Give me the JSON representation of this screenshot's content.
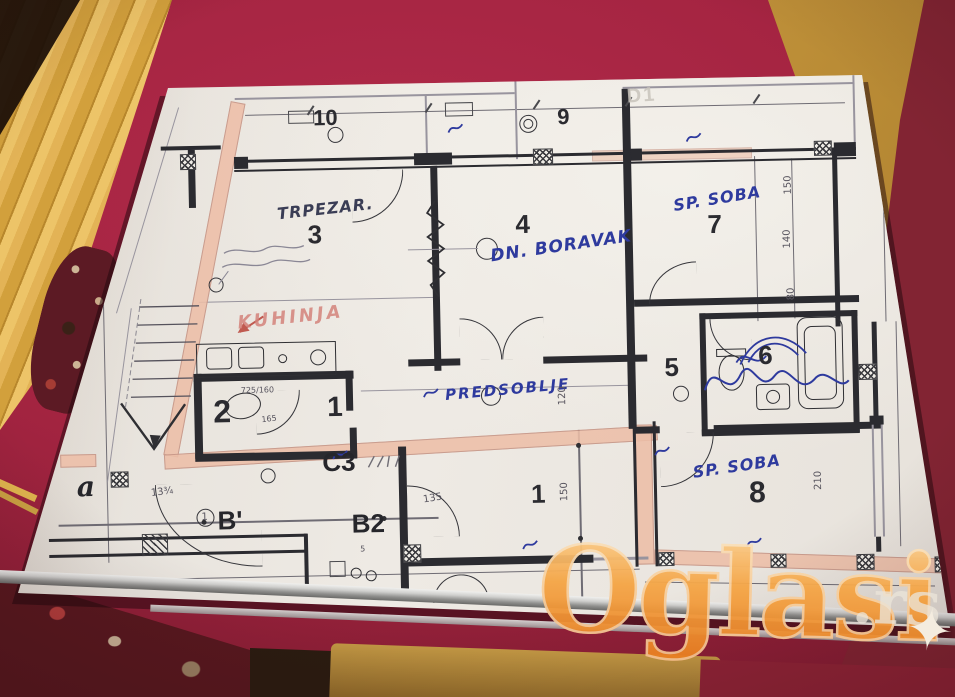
{
  "photo": {
    "watermark": {
      "text": "Oglasi",
      "suffix": ".rs",
      "sparkle": "✦"
    }
  },
  "plan": {
    "rooms": {
      "r10": {
        "num": "10"
      },
      "r9": {
        "num": "9"
      },
      "r3": {
        "num": "3",
        "label": "TRPEZAR."
      },
      "r4": {
        "num": "4",
        "label": "DN. BORAVAK"
      },
      "r7": {
        "num": "7",
        "label": "SP. SOBA"
      },
      "r2": {
        "num": "2"
      },
      "r1mid": {
        "num": "1"
      },
      "r5": {
        "num": "5"
      },
      "r6": {
        "num": "6"
      },
      "r8": {
        "num": "8",
        "label": "SP. SOBA"
      },
      "r1low": {
        "num": "1"
      }
    },
    "labels": {
      "kitchen": "KUHINJA",
      "hall": "PREDSOBLJE"
    },
    "axes": {
      "a": "a",
      "b1": "B'",
      "b2": "B2",
      "c3": "C3"
    },
    "dims": {
      "right_top": "150",
      "right_mid": "140",
      "right_low": "80",
      "hall": "120",
      "low_room": "150",
      "room8": "210",
      "c3_door": "135",
      "slope": "13¾",
      "bath_note": "725/160",
      "bath_dim": "165",
      "b2_small": "5"
    },
    "marks": {
      "ghost": "D1",
      "circled_one": "1"
    }
  }
}
